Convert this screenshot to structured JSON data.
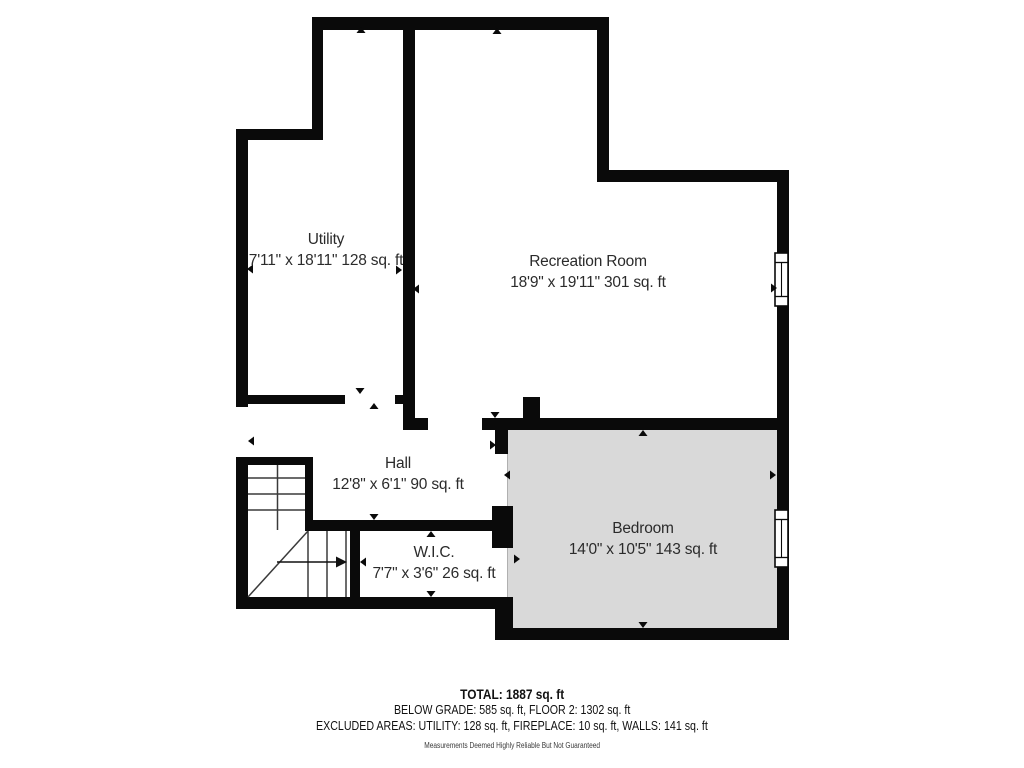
{
  "title": "Basement floor plan",
  "rooms": {
    "utility": {
      "name": "Utility",
      "dims": "7'11\" x 18'11\" 128 sq. ft"
    },
    "recreation_room": {
      "name": "Recreation Room",
      "dims": "18'9\" x 19'11\" 301 sq. ft"
    },
    "hall": {
      "name": "Hall",
      "dims": "12'8\" x 6'1\" 90 sq. ft"
    },
    "wic": {
      "name": "W.I.C.",
      "dims": "7'7\" x 3'6\" 26 sq. ft"
    },
    "bedroom": {
      "name": "Bedroom",
      "dims": "14'0\" x 10'5\" 143 sq. ft"
    }
  },
  "summary": {
    "total_line": "TOTAL: 1887 sq. ft",
    "below_grade_line": "BELOW GRADE: 585 sq. ft, FLOOR 2: 1302 sq. ft",
    "excluded_line": "EXCLUDED AREAS: UTILITY: 128 sq. ft, FIREPLACE: 10 sq. ft, WALLS: 141 sq. ft",
    "disclaimer": "Measurements Deemed Highly Reliable But Not Guaranteed"
  },
  "icons": {
    "window": "window-symbol",
    "door_arrow": "direction-triangle",
    "stairs": "stair-run-with-arrow"
  },
  "colors": {
    "wall": "#0a0a0a",
    "room_fill": "#ffffff",
    "bedroom_fill": "#d9d9d9",
    "text": "#2b2b2b"
  }
}
